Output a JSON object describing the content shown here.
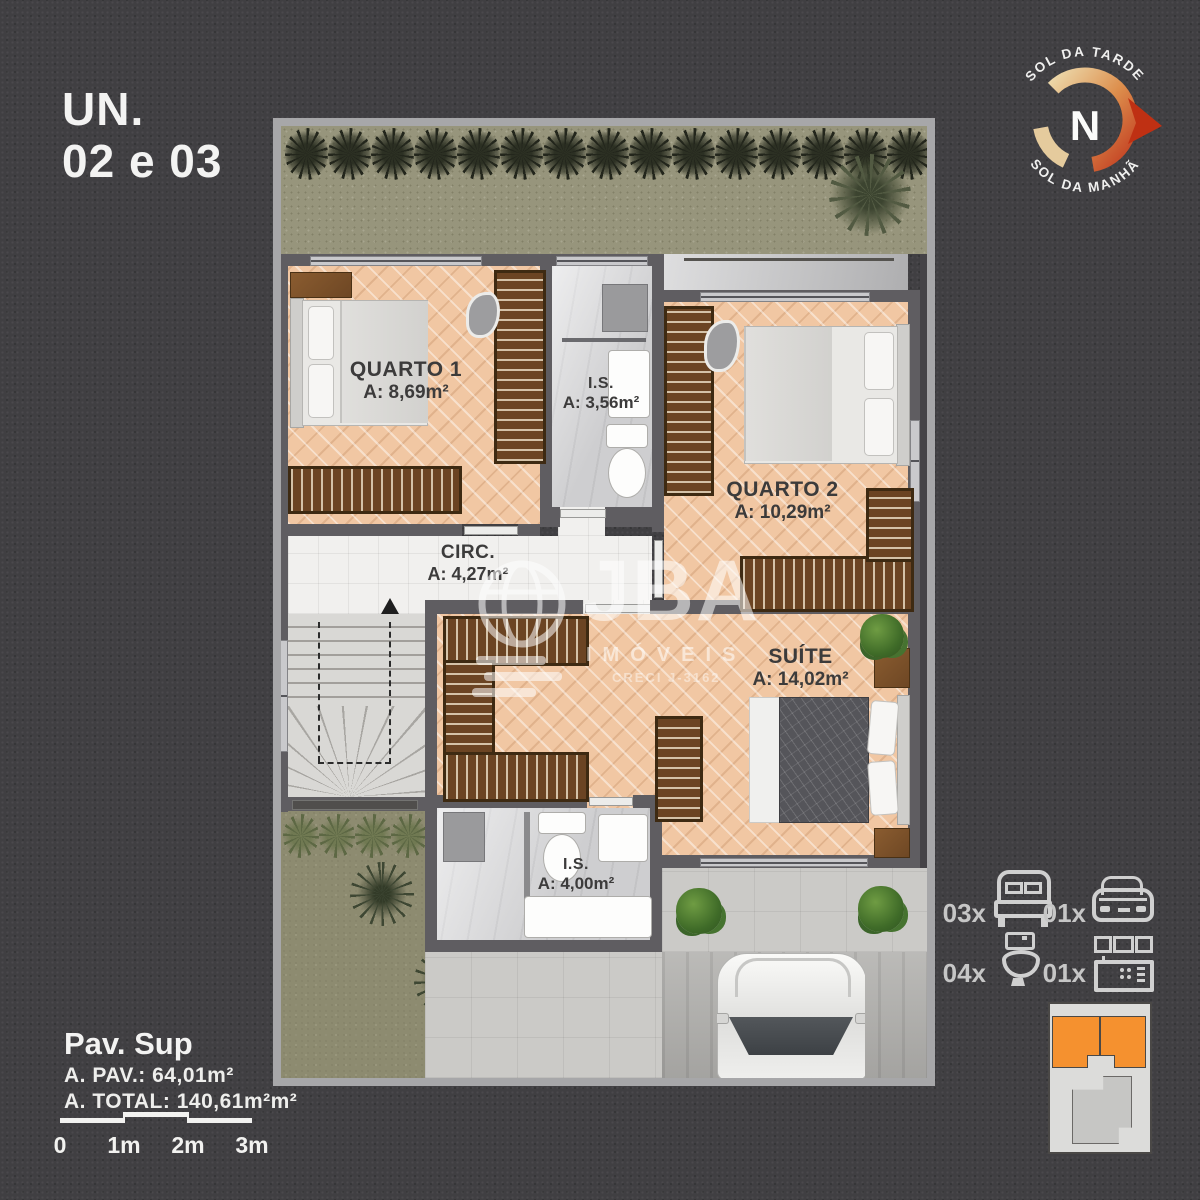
{
  "header": {
    "line1": "UN.",
    "line2": "02 e 03"
  },
  "compass": {
    "top": "SOL DA TARDE",
    "bottom": "SOL DA MANHÃ",
    "center": "N"
  },
  "watermark": {
    "brand": "JBA",
    "subtitle": "IMÓVEIS",
    "creci": "CRECI J-3162"
  },
  "rooms": {
    "quarto1": {
      "name": "QUARTO 1",
      "area": "A: 8,69m²"
    },
    "banheiro1": {
      "name": "I.S.",
      "area": "A: 3,56m²"
    },
    "quarto2": {
      "name": "QUARTO 2",
      "area": "A: 10,29m²"
    },
    "circulacao": {
      "name": "CIRC.",
      "area": "A: 4,27m²"
    },
    "suite": {
      "name": "SUÍTE",
      "area": "A: 14,02m²"
    },
    "banheiro2": {
      "name": "I.S.",
      "area": "A: 4,00m²"
    }
  },
  "footer": {
    "floor": "Pav. Sup",
    "pav_area": "A. PAV.: 64,01m²",
    "total_area": "A. TOTAL: 140,61m²m²"
  },
  "scalebar": {
    "t0": "0",
    "t1": "1m",
    "t2": "2m",
    "t3": "3m"
  },
  "legend": {
    "beds": {
      "count": "03x",
      "icon": "bed-icon"
    },
    "cars": {
      "count": "01x",
      "icon": "car-icon"
    },
    "toilets": {
      "count": "04x",
      "icon": "toilet-icon"
    },
    "kitchens": {
      "count": "01x",
      "icon": "kitchen-icon"
    }
  },
  "colors": {
    "background": "#403f42",
    "lot_frame": "#a7a7a9",
    "wall": "#5f5d61",
    "wood_floor": "#f1c7a3",
    "closet_wood": "#6b4423",
    "bath_floor": "#d9d9db",
    "garden": "#97957c",
    "accent_orange": "#f5912f",
    "compass_red": "#c23c20",
    "label_text": "#3c3b3b",
    "light_text": "#f3f3f2"
  }
}
